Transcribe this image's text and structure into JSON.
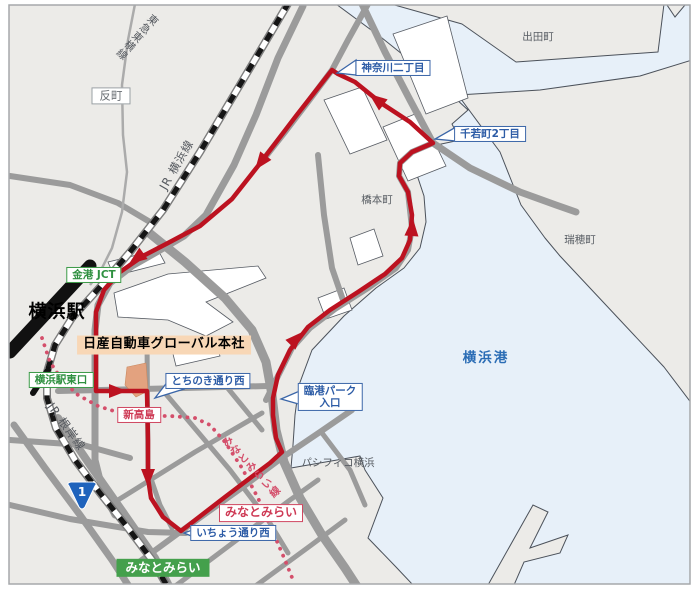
{
  "map_type": "route-map",
  "labels": {
    "tammachi": "反町",
    "tokyu_toyoko_line": "東急東横線",
    "jr_yokohama_line": "JR 横浜線",
    "jr_negishi_line": "JR 根岸線",
    "minatomirai_line": "みなとみらい線",
    "kanagawa_nichome": "神奈川二丁目",
    "chiwakacho_2chome": "千若町2丁目",
    "idetacho": "出田町",
    "hashimotocho": "橋本町",
    "mizuhocho": "瑞穂町",
    "yokohama_port": "横浜港",
    "pacifico_yokohama": "パシフィコ横浜",
    "kinko_jct": "金港 JCT",
    "yokohama_station": "横浜駅",
    "nissan_hq": "日産自動車グローバル本社",
    "yokohama_sta_east_exit": "横浜駅東口",
    "tochinoki_dori_west": "とちのき通り西",
    "shin_takashima": "新高島",
    "rinko_park_l1": "臨港パーク",
    "rinko_park_l2": "入口",
    "minatomirai_sta": "みなとみらい",
    "icho_dori_west": "いちょう通り西",
    "minatomirai_green": "みなとみらい",
    "route1_shield": "1"
  },
  "colors": {
    "land": "#ecebe8",
    "water": "#e7f0f9",
    "coastline": "#4b515a",
    "road": "#9b9b9b",
    "route_red": "#bc1220",
    "minatomirai_line_pink": "#d44f6b",
    "callout_blue": "#2d5ca6",
    "station_green": "#3a9a46",
    "green_fill": "#44a04c",
    "hq_label_bg": "#f8d7b6",
    "hq_building": "#e3a27f",
    "route_shield_blue": "#1f63bc",
    "port_text_blue": "#2a6cb5"
  }
}
